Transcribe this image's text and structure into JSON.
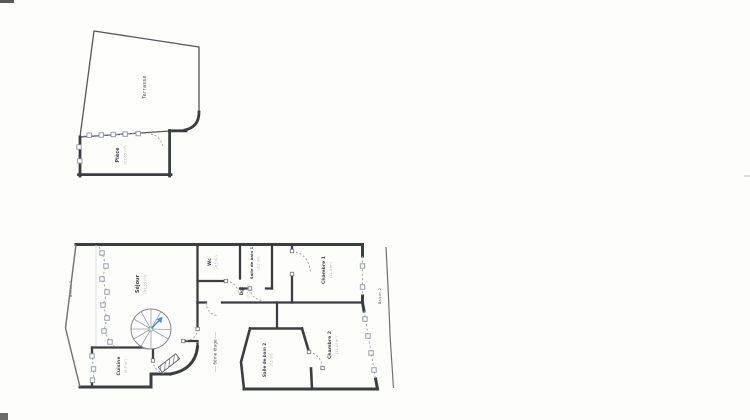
{
  "page": {
    "background": "#fdfdfb"
  },
  "plan": {
    "floor_note": "---- 6ème étage ----",
    "upper": {
      "terrasse": {
        "name": "Terrasse",
        "area": ""
      },
      "piece": {
        "name": "Pièce",
        "area": "(17,65 m²)"
      }
    },
    "rooms": {
      "balcon1": {
        "name": "Balcon 1",
        "area": ""
      },
      "sejour": {
        "name": "Séjour",
        "area": "(45,55 m²)"
      },
      "cuisine": {
        "name": "Cuisine",
        "area": "(8,9 m²)"
      },
      "wc": {
        "name": "Wc",
        "area": "(4,5 m²)"
      },
      "sdb1": {
        "name": "Salle de bain 1",
        "area": "(3,2 m²)"
      },
      "dgt": {
        "name": "Dgt",
        "area": "(7,5 m²)"
      },
      "chambre1": {
        "name": "Chambre 1",
        "area": "(11,4 m²)"
      },
      "balcon2": {
        "name": "Balcon 2",
        "area": ""
      },
      "chambre2": {
        "name": "Chambre 2",
        "area": "(23,45 m²)"
      },
      "sdb2": {
        "name": "Salle de bain 2",
        "area": "(7,5 m²)"
      }
    },
    "colors": {
      "wall": "#3c3d41",
      "thin_line": "#6f7074",
      "window": "#8f959c",
      "dash": "#9aa0a8",
      "stair_arrow": "#4a8fd4"
    }
  }
}
